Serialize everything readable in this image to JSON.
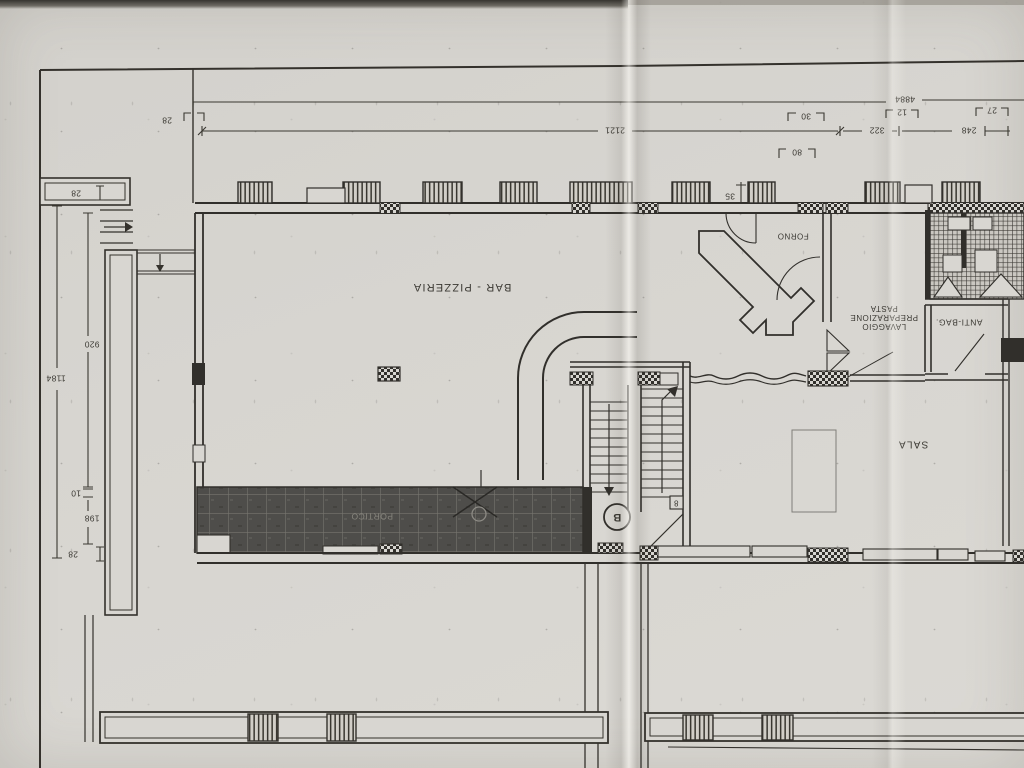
{
  "labels": {
    "bar_pizzeria": "BAR - PIZZERIA",
    "sala": "SALA",
    "forno": "FORNO",
    "lavaggio_line1": "LAVAGGIO",
    "lavaggio_line2": "PREPARAZIONE",
    "lavaggio_line3": "PASTA",
    "anti_bag": "ANTI-BAG.",
    "portico": "PORTICO",
    "stair_letter": "B",
    "stair_tag": "8"
  },
  "dimensions": {
    "top_offset": "28",
    "top_span": "2121",
    "top_total": "4884",
    "c30": "30",
    "c12": "12",
    "c27": "27",
    "c322": "322",
    "c248": "248",
    "c80": "80",
    "c35": "35",
    "left_offset_top": "28",
    "left_upper": "920",
    "left_total": "1184",
    "left_gap": "10",
    "left_lower": "198",
    "left_offset_bottom": "28"
  },
  "colors": {
    "paper": "#d6d4cf",
    "ink": "#33312d",
    "tile_dark": "#4f4e4b"
  }
}
